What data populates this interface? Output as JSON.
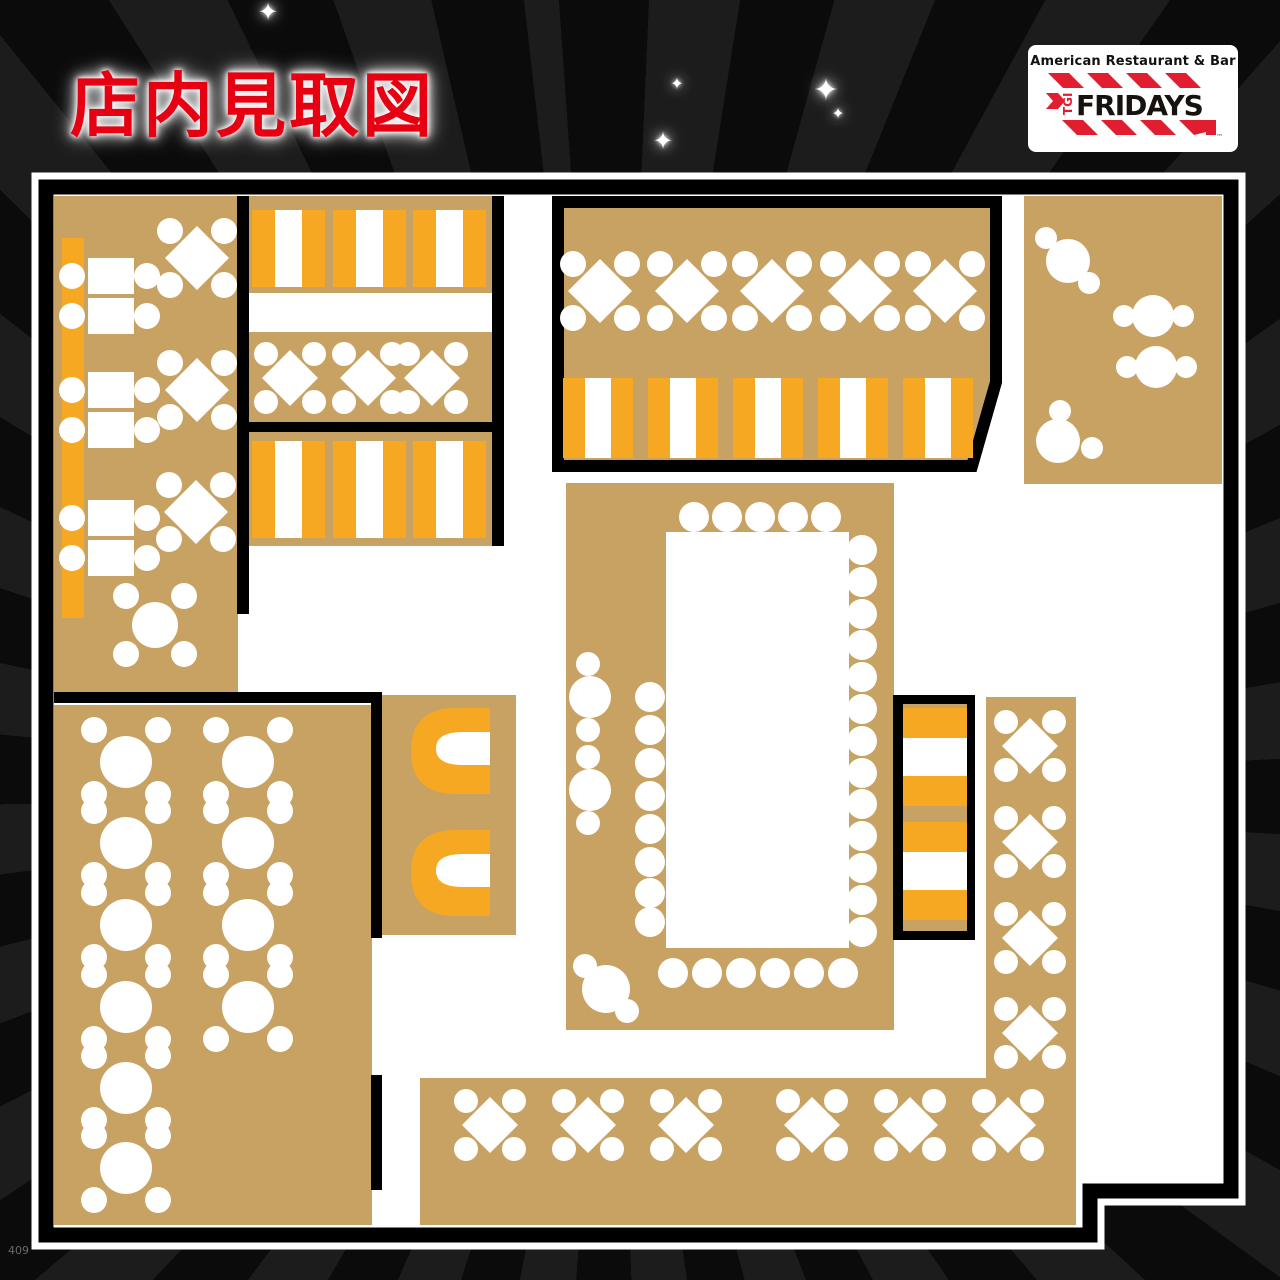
{
  "page": {
    "title": "店内見取図",
    "footer_code": "409"
  },
  "logo": {
    "tagline": "American Restaurant & Bar",
    "tgi": "TGI",
    "fridays": "FRIDAYS",
    "trademark": "™"
  },
  "decor": {
    "sparkle_glyph": "✦"
  },
  "colors": {
    "background": "#0b0b0b",
    "ray": "#1c1c1c",
    "plan_floor": "#ffffff",
    "seating_tan": "#c8a262",
    "accent_orange": "#f7a823",
    "wall_black": "#000000",
    "title_red": "#e60012",
    "logo_red": "#e11e30"
  }
}
